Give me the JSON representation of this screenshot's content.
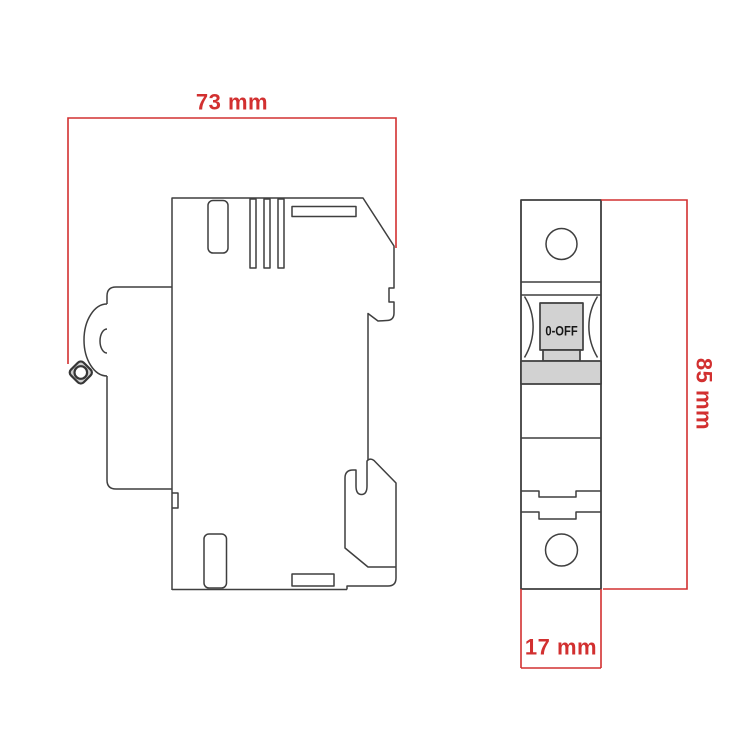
{
  "drawing": {
    "toggle_label": "0-OFF",
    "dimensions": {
      "depth": "73 mm",
      "height": "85 mm",
      "width": "17 mm"
    },
    "colors": {
      "dimension_red": "#d23030",
      "outline_gray": "#3f3f3f",
      "fill_gray": "#d2d2d2",
      "background": "#ffffff"
    }
  }
}
